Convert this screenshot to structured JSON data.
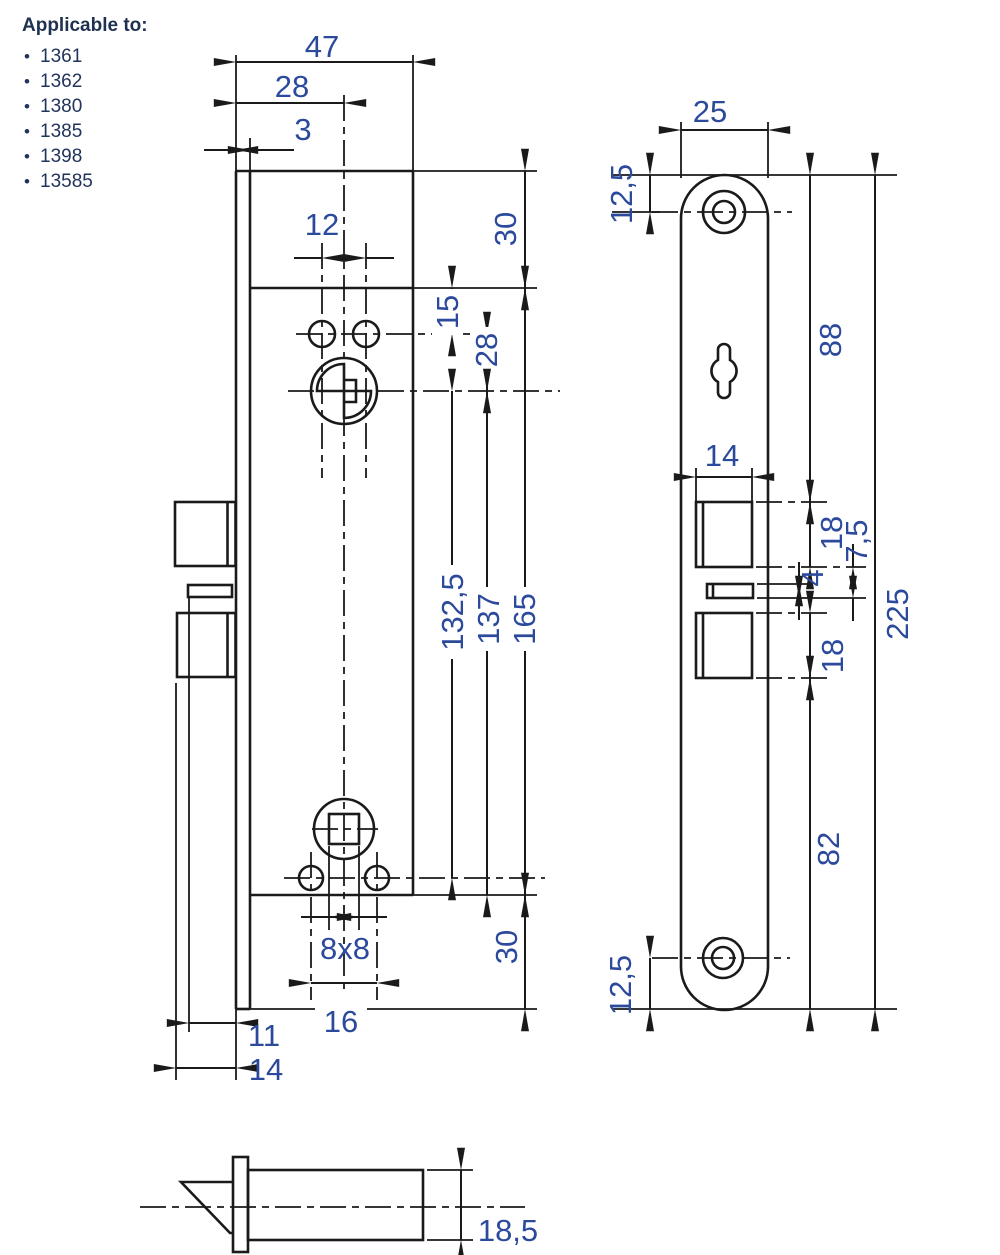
{
  "applicable_to": {
    "heading": "Applicable to:",
    "items": [
      "1361",
      "1362",
      "1380",
      "1385",
      "1398",
      "13585"
    ]
  },
  "colors": {
    "line": "#1a1a1a",
    "dimension_text": "#2c4a9c",
    "heading_text": "#1f3150",
    "background": "#ffffff"
  },
  "views": {
    "side_view": {
      "overall_width": "47",
      "backset": "28",
      "faceplate_thickness": "3",
      "top_hole_spacing": "12",
      "top_margin": "30",
      "case_top_to_holes": "15",
      "holes_to_cylinder": "28",
      "cylinder_to_lower_holes": "132,5",
      "cylinder_to_case_bottom": "137",
      "case_height": "165",
      "bottom_margin": "30",
      "spindle_square": "8x8",
      "lower_hole_spacing": "16",
      "deadbolt_projection": "11",
      "latch_projection": "14"
    },
    "faceplate_view": {
      "width": "25",
      "top_to_hole": "12,5",
      "top_to_latch_cutout": "88",
      "cutout_width": "14",
      "latch_cutout_height": "18",
      "latch_to_slot": "7,5",
      "slot_height": "4",
      "deadbolt_cutout_height": "18",
      "deadbolt_to_bottom": "82",
      "total_height": "225",
      "hole_to_bottom": "12,5"
    },
    "latch_detail": {
      "latch_height": "18,5"
    }
  }
}
